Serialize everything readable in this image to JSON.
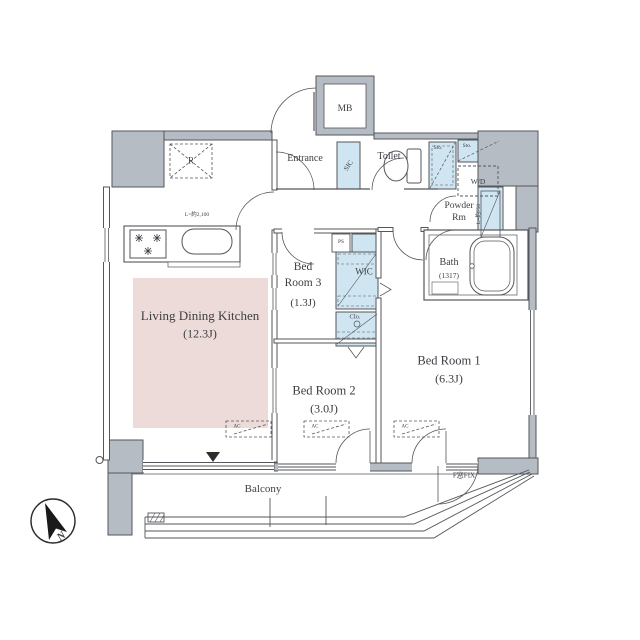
{
  "floor_plan": {
    "rooms": {
      "ldk": {
        "name": "Living Dining Kitchen",
        "size": "(12.3J)"
      },
      "bed1": {
        "name": "Bed Room 1",
        "size": "(6.3J)"
      },
      "bed2": {
        "name": "Bed Room 2",
        "size": "(3.0J)"
      },
      "bed3": {
        "name_line1": "Bed",
        "name_line2": "Room 3",
        "size": "(1.3J)"
      },
      "entrance": {
        "name": "Entrance"
      },
      "toilet": {
        "name": "Toilet"
      },
      "powder": {
        "name_line1": "Powder",
        "name_line2": "Rm"
      },
      "bath": {
        "name": "Bath",
        "size": "(1317)"
      }
    },
    "storage": {
      "sic": "SIC",
      "wic": "WIC",
      "clo": "Clo.",
      "sto": "Sto.",
      "ps": "PS",
      "mb": "MB",
      "fridge": "R"
    },
    "fixtures": {
      "washer_dryer": "W/D",
      "air_conditioner": "AC",
      "fix_window": "F窓FIX",
      "kitchen_counter_length": "L=約2,100",
      "mirror_cabinet_length": "L=約750"
    },
    "outdoor": {
      "balcony": "Balcony"
    },
    "compass": {
      "north": "N"
    },
    "colors": {
      "wall_fill": "#b6bcc4",
      "storage_fill": "#cfe5f1",
      "ldk_highlight": "#eddbd9",
      "line": "#54565b"
    }
  }
}
